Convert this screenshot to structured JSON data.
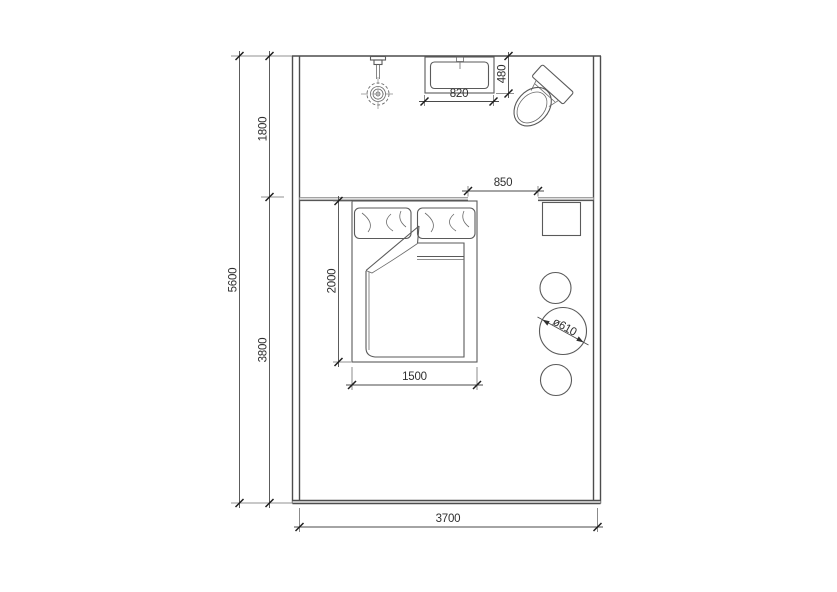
{
  "dimensions": {
    "overall_depth": "5600",
    "upper_zone_depth": "1800",
    "lower_zone_depth": "3800",
    "overall_width": "3700",
    "basin_width": "820",
    "basin_depth": "480",
    "opening_width": "850",
    "bed_length": "2000",
    "bed_width": "1500",
    "table_diameter": "ø610"
  },
  "colors": {
    "line": "#4d4d4d",
    "dimension_text": "#2f2f2f",
    "partition_light": "#a3a3a3",
    "background": "#ffffff"
  }
}
